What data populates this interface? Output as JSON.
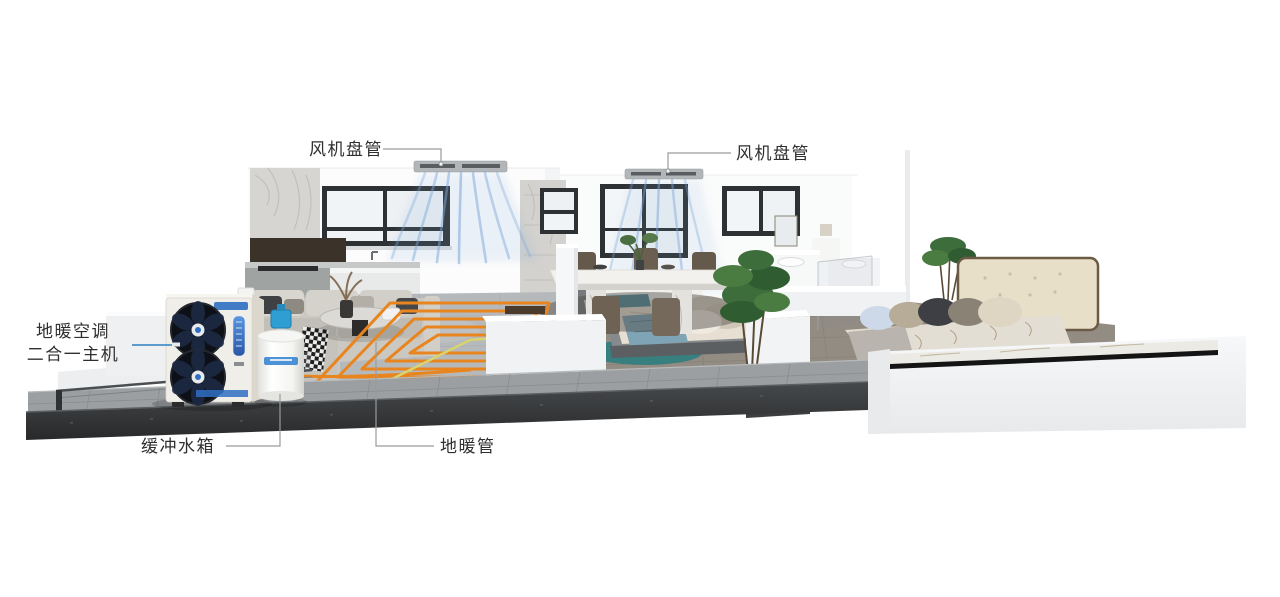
{
  "illustration": {
    "components": [
      "fan-coil-unit-left",
      "fan-coil-unit-right",
      "heat-pump-main-unit",
      "buffer-water-tank",
      "floor-heating-coil",
      "airflow-streams",
      "house-cutaway"
    ]
  },
  "labels": {
    "fan_coil_left": "风机盘管",
    "fan_coil_right": "风机盘管",
    "main_unit_line1": "地暖空调",
    "main_unit_line2": "二合一主机",
    "buffer_tank": "缓冲水箱",
    "floor_pipe": "地暖管"
  },
  "colors": {
    "label_text": "#2f2f2f",
    "callout_line": "#9b9b9b",
    "callout_accent": "#2b80c4",
    "pipe_orange": "#e8851f",
    "pipe_yellow": "#d8d46e",
    "air_blue": "#7aa6d8",
    "tank_valve": "#2f9ed2",
    "rug_teal": "#2f7d80"
  }
}
